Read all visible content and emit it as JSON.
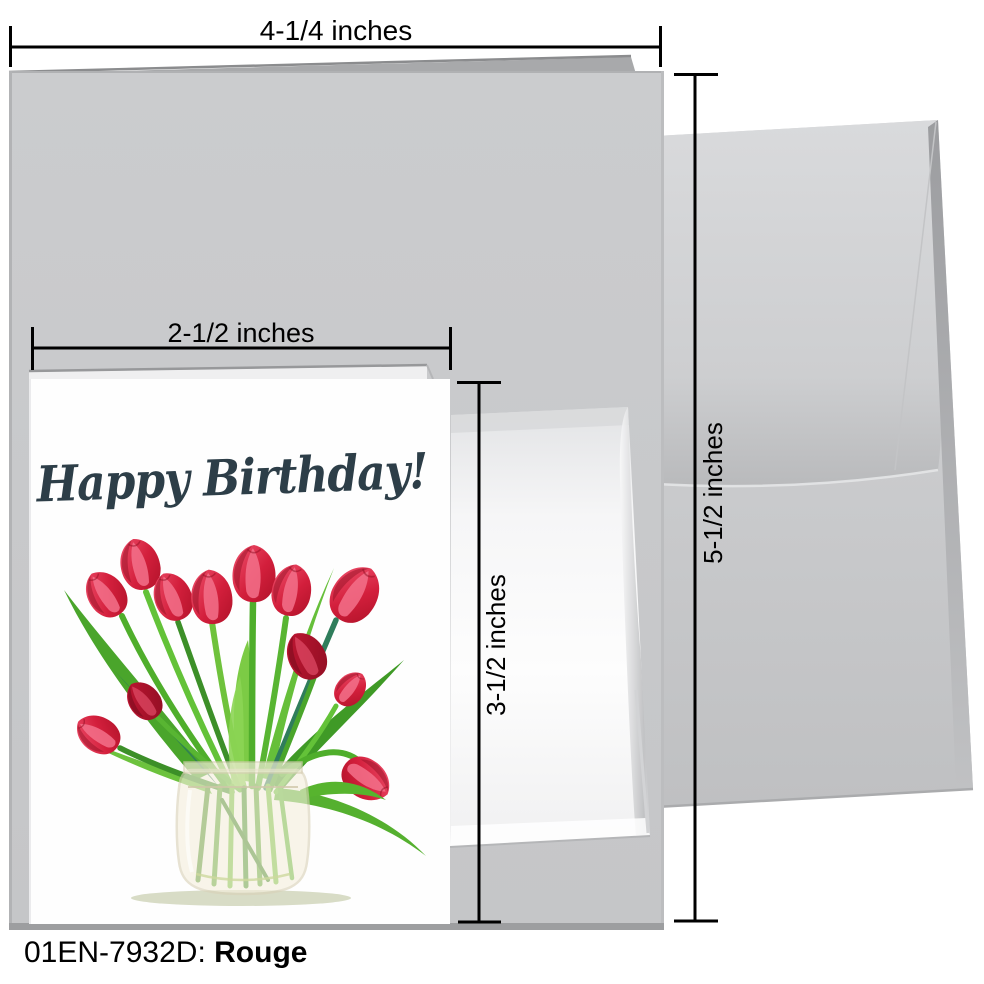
{
  "footer": {
    "code": "01EN-7932D:",
    "name": "Rouge"
  },
  "card": {
    "greeting": "Happy Birthday!"
  },
  "dimensions": {
    "large_width": "4-1/4 inches",
    "large_height": "5-1/2 inches",
    "small_width": "2-1/2 inches",
    "small_height": "3-1/2 inches"
  },
  "colors": {
    "card_gray": "#c8c9cb",
    "envelope_gray": "#cdced0",
    "greeting_ink": "#2d3e48",
    "tulip_red": "#d31f3c",
    "tulip_pink": "#f3718b",
    "tulip_dark_red": "#8f0e22",
    "leaf_green": "#5cb433",
    "jar_cream": "#f5efdd",
    "dimension_line": "#000000"
  }
}
